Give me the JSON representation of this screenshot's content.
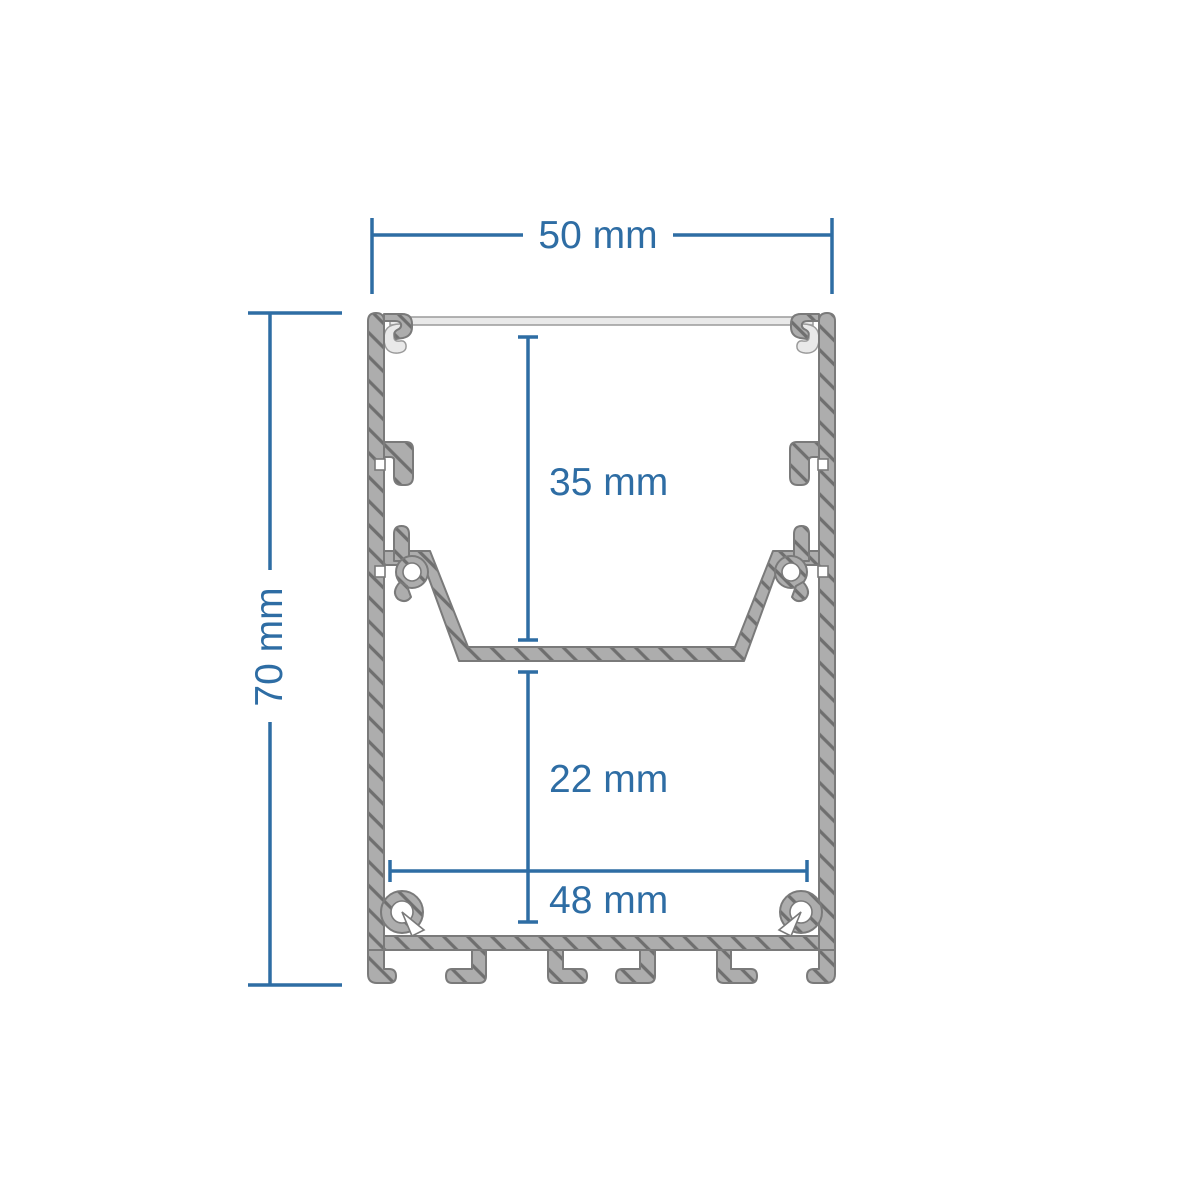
{
  "drawing": {
    "title": "aluminium-led-profile-cross-section",
    "dimensions": {
      "outer_width": {
        "label": "50 mm",
        "value": 50,
        "unit": "mm",
        "orientation": "horizontal"
      },
      "outer_height": {
        "label": "70 mm",
        "value": 70,
        "unit": "mm",
        "orientation": "vertical"
      },
      "upper_cavity_depth": {
        "label": "35 mm",
        "value": 35,
        "unit": "mm",
        "orientation": "vertical"
      },
      "lower_cavity_depth": {
        "label": "22 mm",
        "value": 22,
        "unit": "mm",
        "orientation": "vertical"
      },
      "inner_bottom_width": {
        "label": "48 mm",
        "value": 48,
        "unit": "mm",
        "orientation": "horizontal"
      }
    },
    "colors": {
      "dimension_blue": "#2e6da4",
      "metal_fill": "#adadad",
      "hatch_line": "#6f6f6f",
      "metal_outline": "#7a7a7a",
      "diffuser_fill": "#e9e9e9",
      "background": "#ffffff"
    }
  }
}
